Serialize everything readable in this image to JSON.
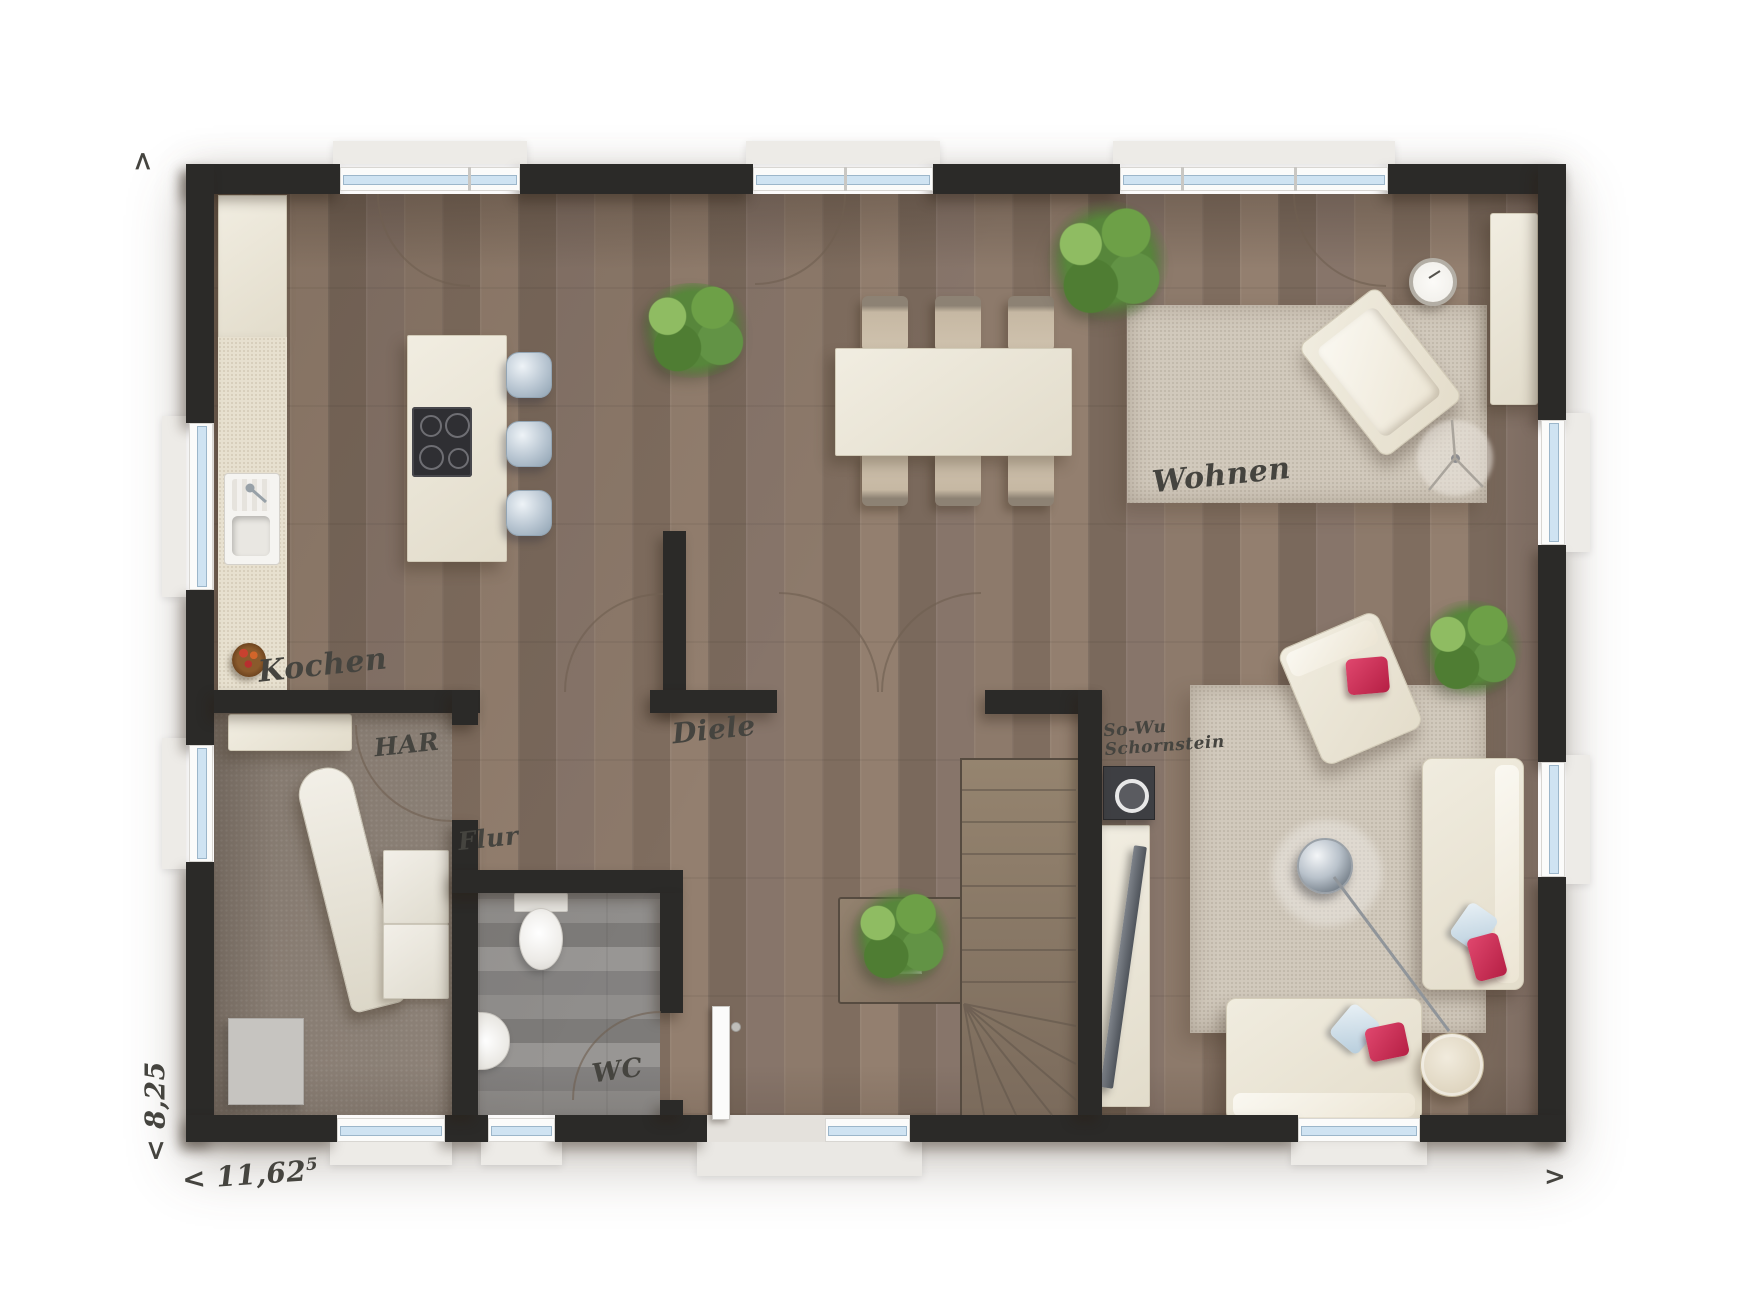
{
  "rooms": {
    "kitchen": "Kochen",
    "living": "Wohnen",
    "utility": "HAR",
    "hall": "Diele",
    "corridor": "Flur",
    "wc": "WC"
  },
  "chimney": {
    "line1": "So-Wu",
    "line2": "Schornstein"
  },
  "dimensions": {
    "width": "< 11,62",
    "width_sup": "5",
    "depth": "< 8,25",
    "arrow_up": ">",
    "arrow_right": ">"
  },
  "colors": {
    "wall": "#2b2a28",
    "wood_floor": "#877466",
    "carpet_utility": "#8e8379",
    "tile_wc": "#8b8987",
    "furniture_cream": "#eae5d8",
    "rug": "#d1c9bc",
    "pillow_red": "#cb2950",
    "pillow_blue": "#cfdfe9",
    "window_glass": "#cfe3f2",
    "plant_green": "#57863b",
    "label_ink": "#45443f"
  }
}
